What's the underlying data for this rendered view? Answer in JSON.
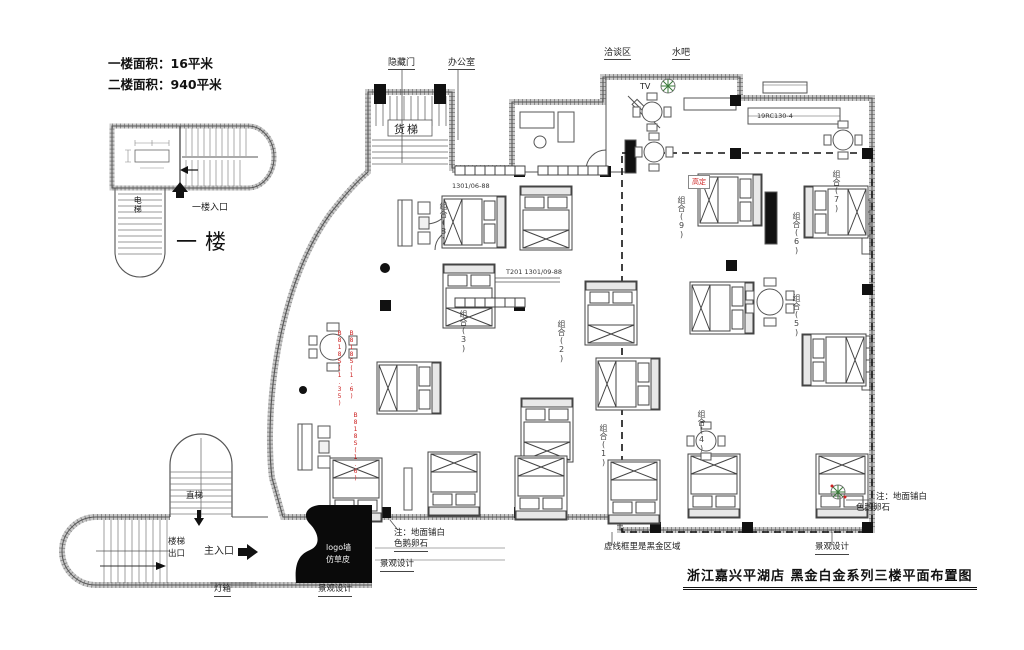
{
  "info_panel": {
    "line1": "一楼面积：16平米",
    "line2": "二楼面积：940平米"
  },
  "first_floor_plan": {
    "name": "一楼",
    "entrance": "一楼入口",
    "elevator": "电梯"
  },
  "rooms": {
    "freight_elevator": "货梯",
    "hidden_door": "隐藏门",
    "office": "办公室",
    "negotiation_area": "洽谈区",
    "water_bar": "水吧",
    "tv": "TV"
  },
  "circulation": {
    "straight_elevator": "直梯",
    "stair_exit_line1": "楼梯",
    "stair_exit_line2": "出口",
    "main_entrance": "主入口",
    "light_box": "灯箱"
  },
  "annotations": {
    "logo_wall": "logo墙",
    "turf": "仿草皮",
    "landscape_design": "景观设计",
    "floor_note_line1": "注：地面铺白",
    "floor_note_line2": "色鹅卵石",
    "black_gold_zone": "虚线框里是黑金区域",
    "custom_red": "高定"
  },
  "combos": [
    "组合(9)",
    "组合(6)",
    "组合(5)",
    "组合(2)",
    "组合(3)",
    "组合(8)",
    "组合(7)",
    "组合(1)",
    "组合(4)"
  ],
  "model_numbers": [
    "1301/06-88",
    "T201 1301/09-88",
    "19RC130-4",
    "B818S(1.35)",
    "B818S(1.6)"
  ],
  "title_block": {
    "title": "浙江嘉兴平湖店 黑金白金系列三楼平面布置图"
  },
  "colors": {
    "red_accent": "#cc2222",
    "wall_gray": "#c9c9c9",
    "line": "#444444"
  }
}
